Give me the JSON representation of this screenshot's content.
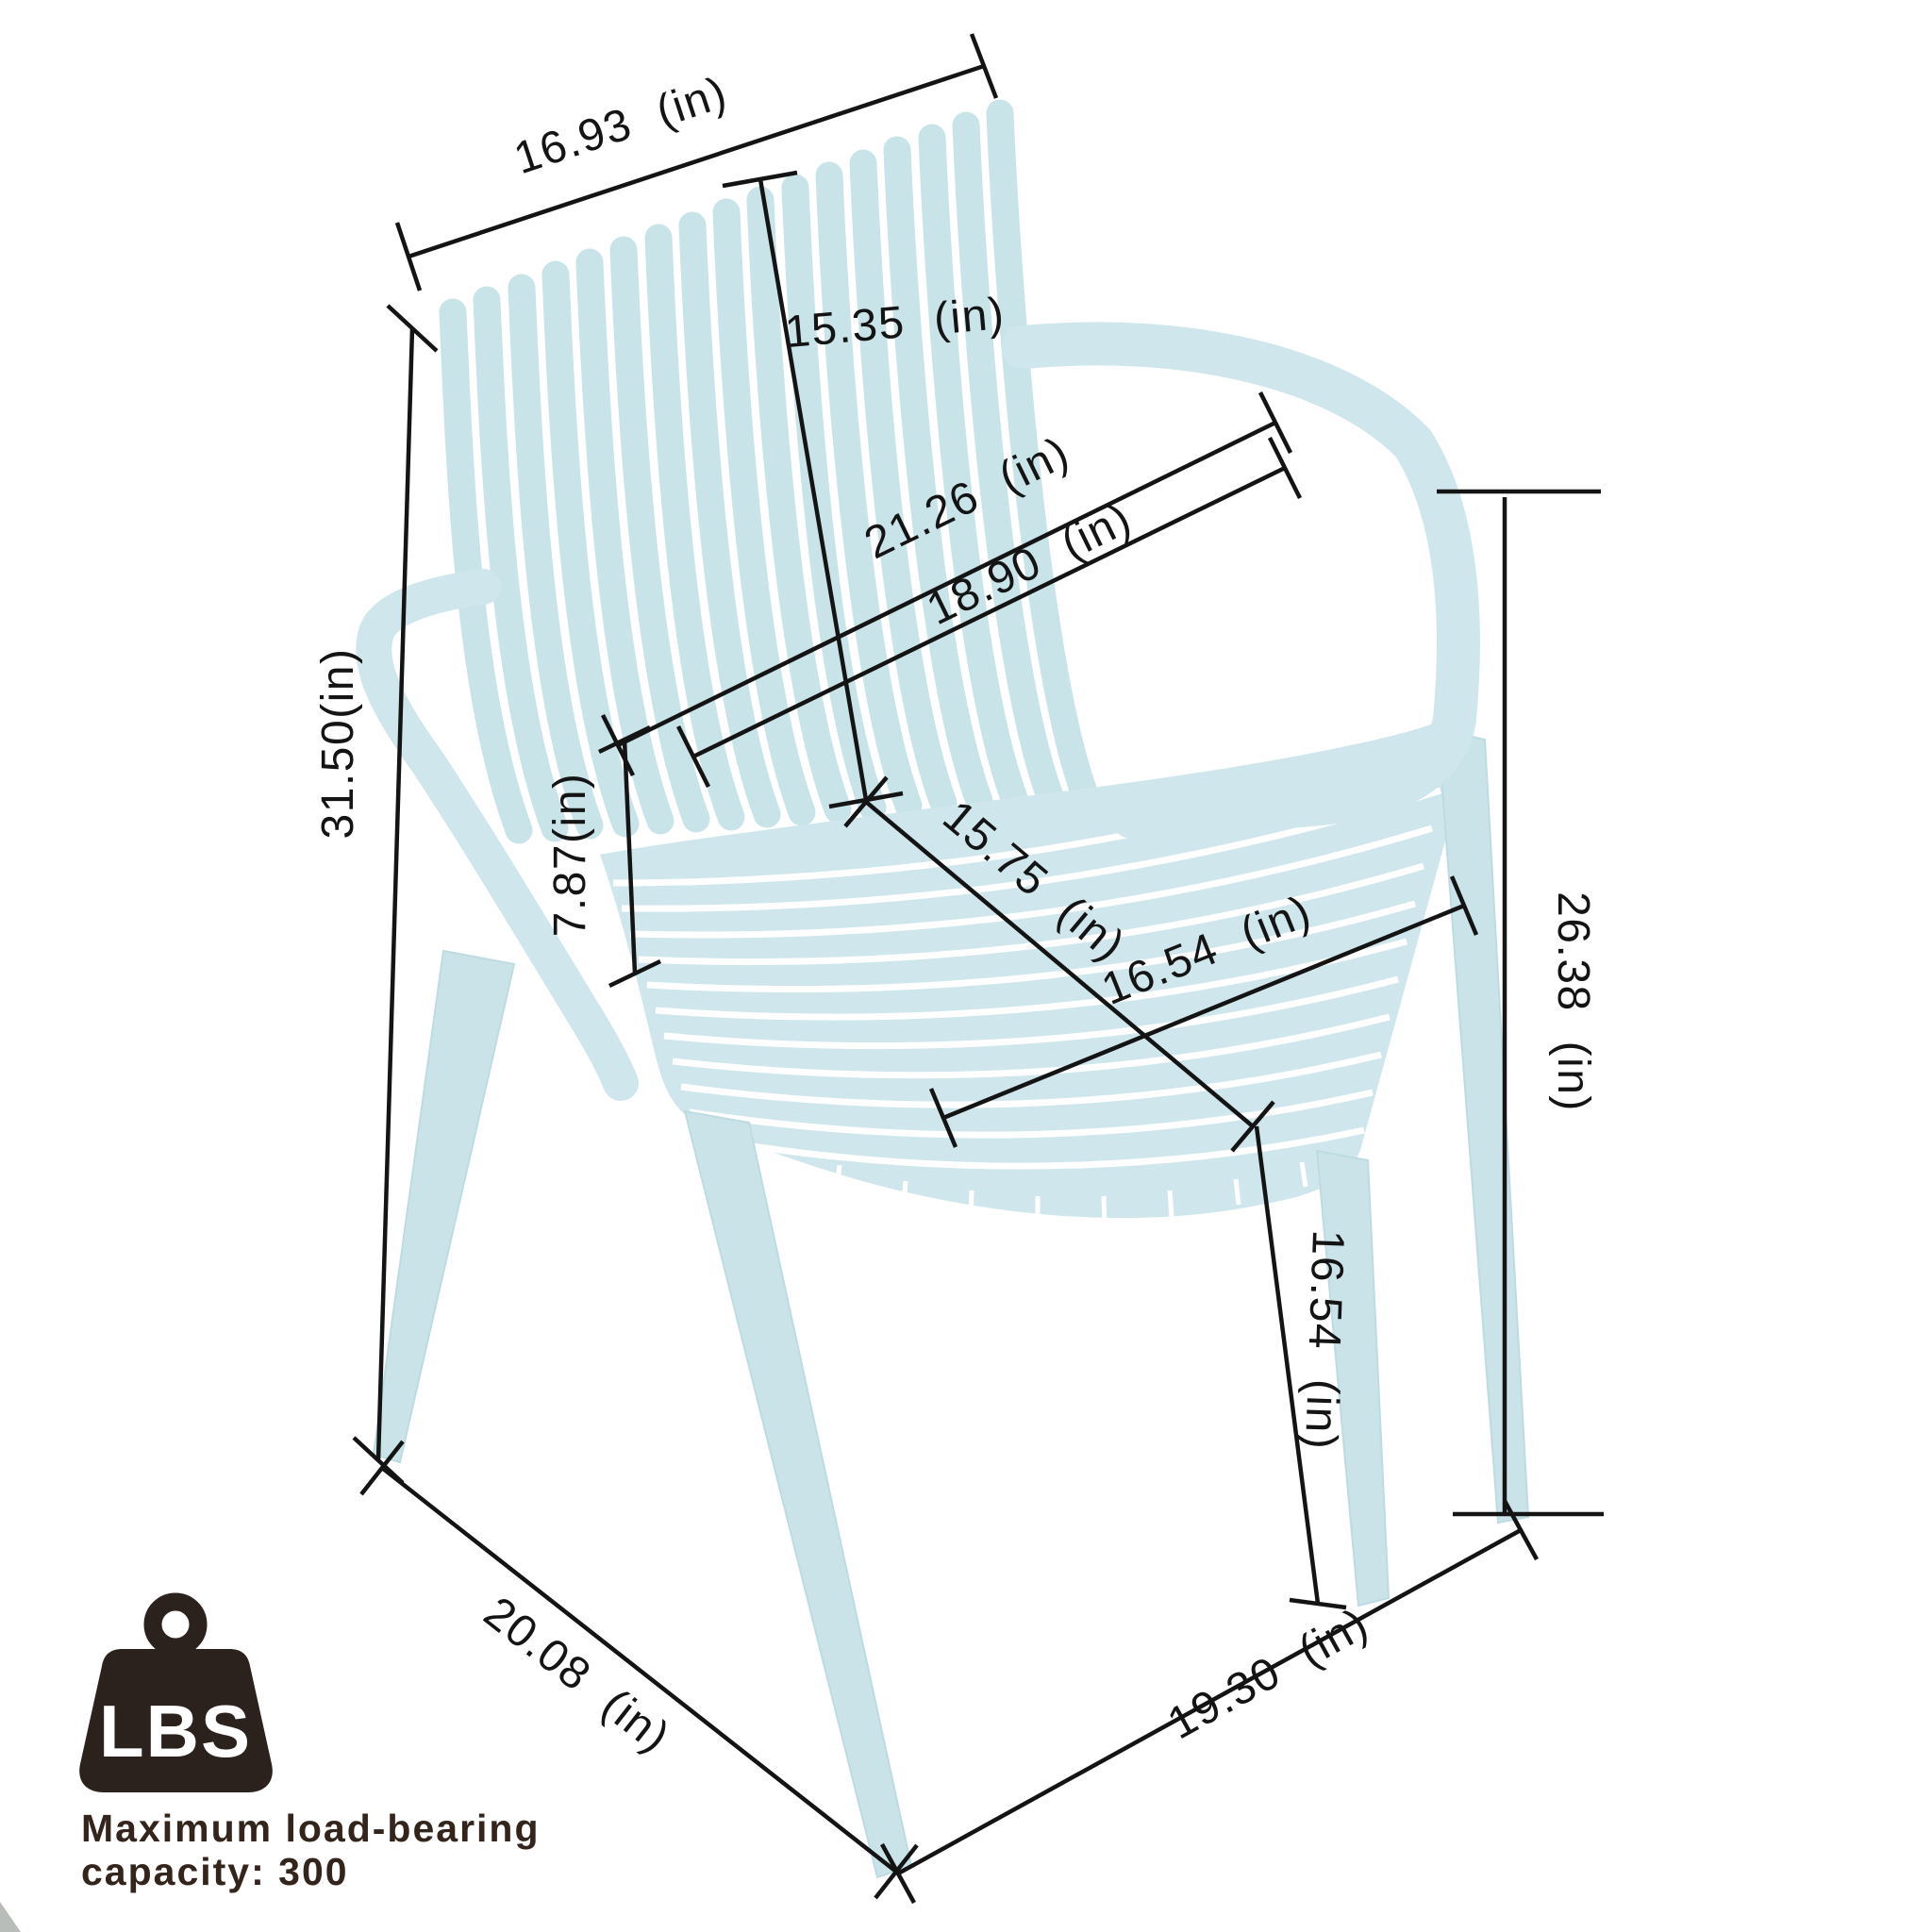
{
  "diagram": {
    "labels": {
      "back_width": "16.93 (in)",
      "back_height": "15.35 (in)",
      "back_diag_outer": "21.26 (in)",
      "back_diag_inner": "18.90 (in)",
      "overall_height": "31.50(in)",
      "armrest_height": "7.87(in)",
      "seat_depth": "15.75 (in)",
      "seat_width": "16.54 (in)",
      "armrest_to_floor": "26.38 (in)",
      "seat_height": "16.54 (in)",
      "base_depth": "20.08 (in)",
      "base_width": "19.30 (in)"
    },
    "load_badge": {
      "unit": "LBS",
      "note_line1": "Maximum load-bearing",
      "note_line2": "capacity: 300"
    },
    "colors": {
      "chair": "#cde6eb",
      "dimension_line": "#141414",
      "badge": "#2b211d",
      "note_text": "#33241c"
    }
  }
}
